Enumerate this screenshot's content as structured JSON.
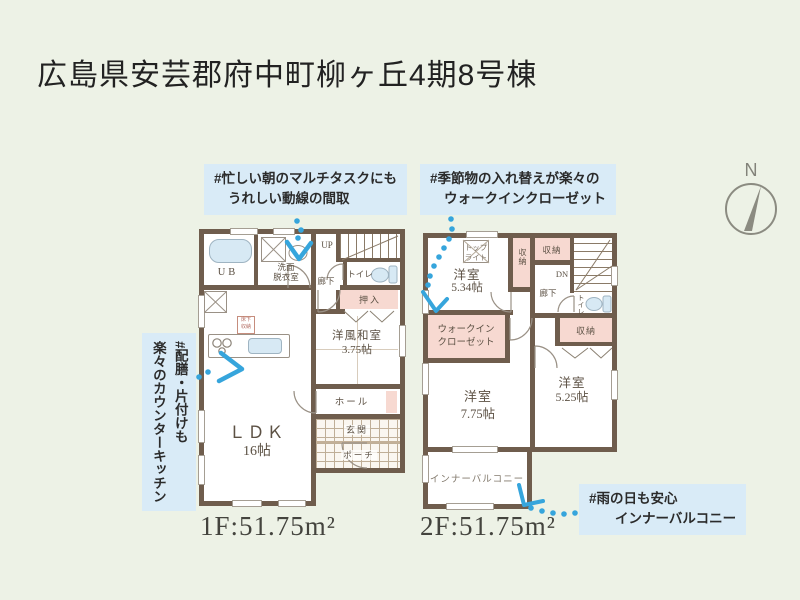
{
  "title": "広島県安芸郡府中町柳ヶ丘4期8号棟",
  "compass": {
    "north": "N"
  },
  "annotations": {
    "morning_l1": "#忙しい朝のマルチタスクにも",
    "morning_l2": "うれしい動線の間取",
    "closet_l1": "#季節物の入れ替えが楽々の",
    "closet_l2": "ウォークインクローゼット",
    "kitchen_l1": "#配膳・片付けも",
    "kitchen_l2": "楽々のカウンターキッチン",
    "balcony_l1": "#雨の日も安心",
    "balcony_l2": "インナーバルコニー"
  },
  "floor1": {
    "area": "1F:51.75m²",
    "ub": "UB",
    "washroom_l1": "洗面",
    "washroom_l2": "脱衣室",
    "up": "UP",
    "toilet": "トイレ",
    "hallway": "廊下",
    "oshiire": "押入",
    "washitsu_l1": "洋風和室",
    "washitsu_l2": "3.75帖",
    "hall": "ホール",
    "entrance": "玄関",
    "porch": "ポーチ",
    "underfloor_l1": "床下",
    "underfloor_l2": "収納",
    "ldk_l1": "ＬＤＫ",
    "ldk_l2": "16帖"
  },
  "floor2": {
    "area": "2F:51.75m²",
    "skylight_l1": "トップ",
    "skylight_l2": "ライト",
    "bedroom534_l1": "洋室",
    "bedroom534_l2": "5.34帖",
    "storage_side": "収納",
    "storage_top": "収納",
    "dn": "DN",
    "hallway": "廊下",
    "toilet": "トイレ",
    "wic_l1": "ウォークイン",
    "wic_l2": "クローゼット",
    "storage_right": "収納",
    "bedroom775_l1": "洋室",
    "bedroom775_l2": "7.75帖",
    "bedroom525_l1": "洋室",
    "bedroom525_l2": "5.25帖",
    "balcony": "インナーバルコニー"
  },
  "colors": {
    "background": "#edf2e6",
    "wall": "#6f5d4d",
    "closet_pink": "#f7d9d1",
    "fixture_blue": "#d7e9f4",
    "annotation_bg": "#d9ebf7",
    "trail_blue": "#36a5dc"
  }
}
